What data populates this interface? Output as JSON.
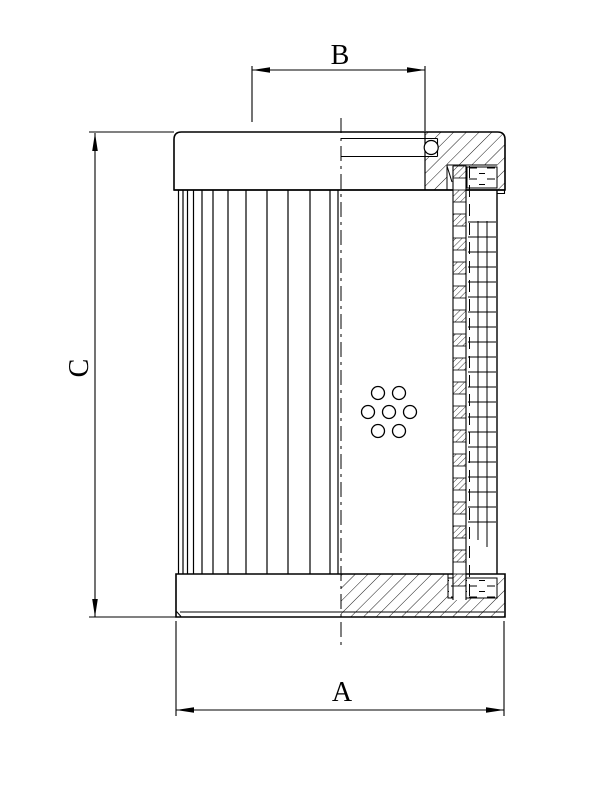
{
  "page": {
    "title": "Filter element cross-section technical drawing",
    "background": "#ffffff",
    "ink": "#000000"
  },
  "dimensions": {
    "b": {
      "label": "B"
    },
    "c": {
      "label": "C"
    },
    "a": {
      "label": "A"
    }
  },
  "geometry": {
    "pleats": {
      "x": [
        178.5,
        183,
        187.5,
        193.5,
        202,
        213,
        228,
        246,
        267,
        288,
        310,
        330,
        338
      ],
      "y1": 190,
      "y2": 574
    },
    "holes": {
      "r": 6.5,
      "centers": [
        [
          378,
          393
        ],
        [
          399,
          393
        ],
        [
          368,
          412
        ],
        [
          389,
          412
        ],
        [
          410,
          412
        ],
        [
          378,
          431
        ],
        [
          399,
          431
        ]
      ]
    },
    "mesh": {
      "tick_x1": 468,
      "tick_x2": 496,
      "tick_y_start": 222,
      "tick_y_end": 522,
      "tick_step": 15,
      "verticals": [
        {
          "x": 478,
          "y1": 221,
          "y2": 540
        },
        {
          "x": 487,
          "y1": 221,
          "y2": 547
        }
      ]
    },
    "core": {
      "x": 453,
      "w": 13,
      "y1": 166,
      "y2": 600,
      "cell": 12
    },
    "centerline": {
      "x": 341,
      "y1": 118,
      "y2": 648,
      "dash": "15 5 3 5"
    },
    "hidden_line": {
      "x": 469.5,
      "y1": 166,
      "y2": 598,
      "dash": "12 7"
    }
  }
}
